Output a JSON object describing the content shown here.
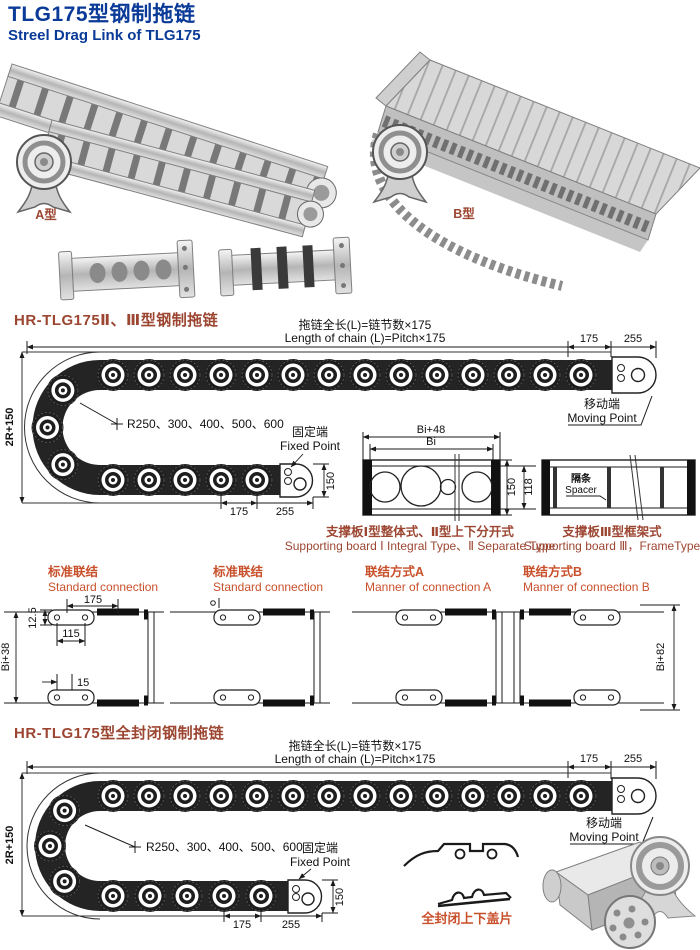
{
  "header": {
    "title": "TLG175型钢制拖链",
    "subtitle": "Streel Drag Link of TLG175"
  },
  "photos": {
    "type_a_label": "A型",
    "type_b_label": "B型"
  },
  "section1": {
    "heading": "HR-TLG175Ⅱ、Ⅲ型钢制拖链"
  },
  "section2": {
    "heading": "HR-TLG175型全封闭钢制拖链",
    "cover_caption": "全封闭上下盖片"
  },
  "drawing": {
    "length_cn": "拖链全长(L)=链节数×175",
    "length_en": "Length of chain (L)=Pitch×175",
    "dim_175": "175",
    "dim_255": "255",
    "dim_150": "150",
    "dim_2r150": "2R+150",
    "radius_note": "R250、300、400、500、600",
    "moving_cn": "移动端",
    "moving_en": "Moving Point",
    "fixed_cn": "固定端",
    "fixed_en": "Fixed Point"
  },
  "boards": {
    "dim_bi48": "Bi+48",
    "dim_bi": "Bi",
    "dim_150": "150",
    "dim_118": "118",
    "spacer_cn": "隔条",
    "spacer_en": "Spacer",
    "board12_cn": "支撑板Ⅰ型整体式、Ⅱ型上下分开式",
    "board12_en": "Supporting board Ⅰ Integral Type、Ⅱ Separate Type",
    "board3_cn": "支撑板Ⅲ型框架式",
    "board3_en": "Supporting board Ⅲ，FrameType"
  },
  "connections": {
    "std1_cn": "标准联结",
    "std1_en": "Standard connection",
    "std2_cn": "标准联结",
    "std2_en": "Standard connection",
    "a_cn": "联结方式A",
    "a_en": "Manner of connection A",
    "b_cn": "联结方式B",
    "b_en": "Manner of connection B",
    "dim_175": "175",
    "dim_125": "12.5",
    "dim_115": "115",
    "dim_15": "15",
    "dim_bi38": "Bi+38",
    "dim_bi82": "Bi+82"
  },
  "colors": {
    "navy": "#0a3a97",
    "brick": "#9c4632",
    "orange": "#c8502b"
  }
}
